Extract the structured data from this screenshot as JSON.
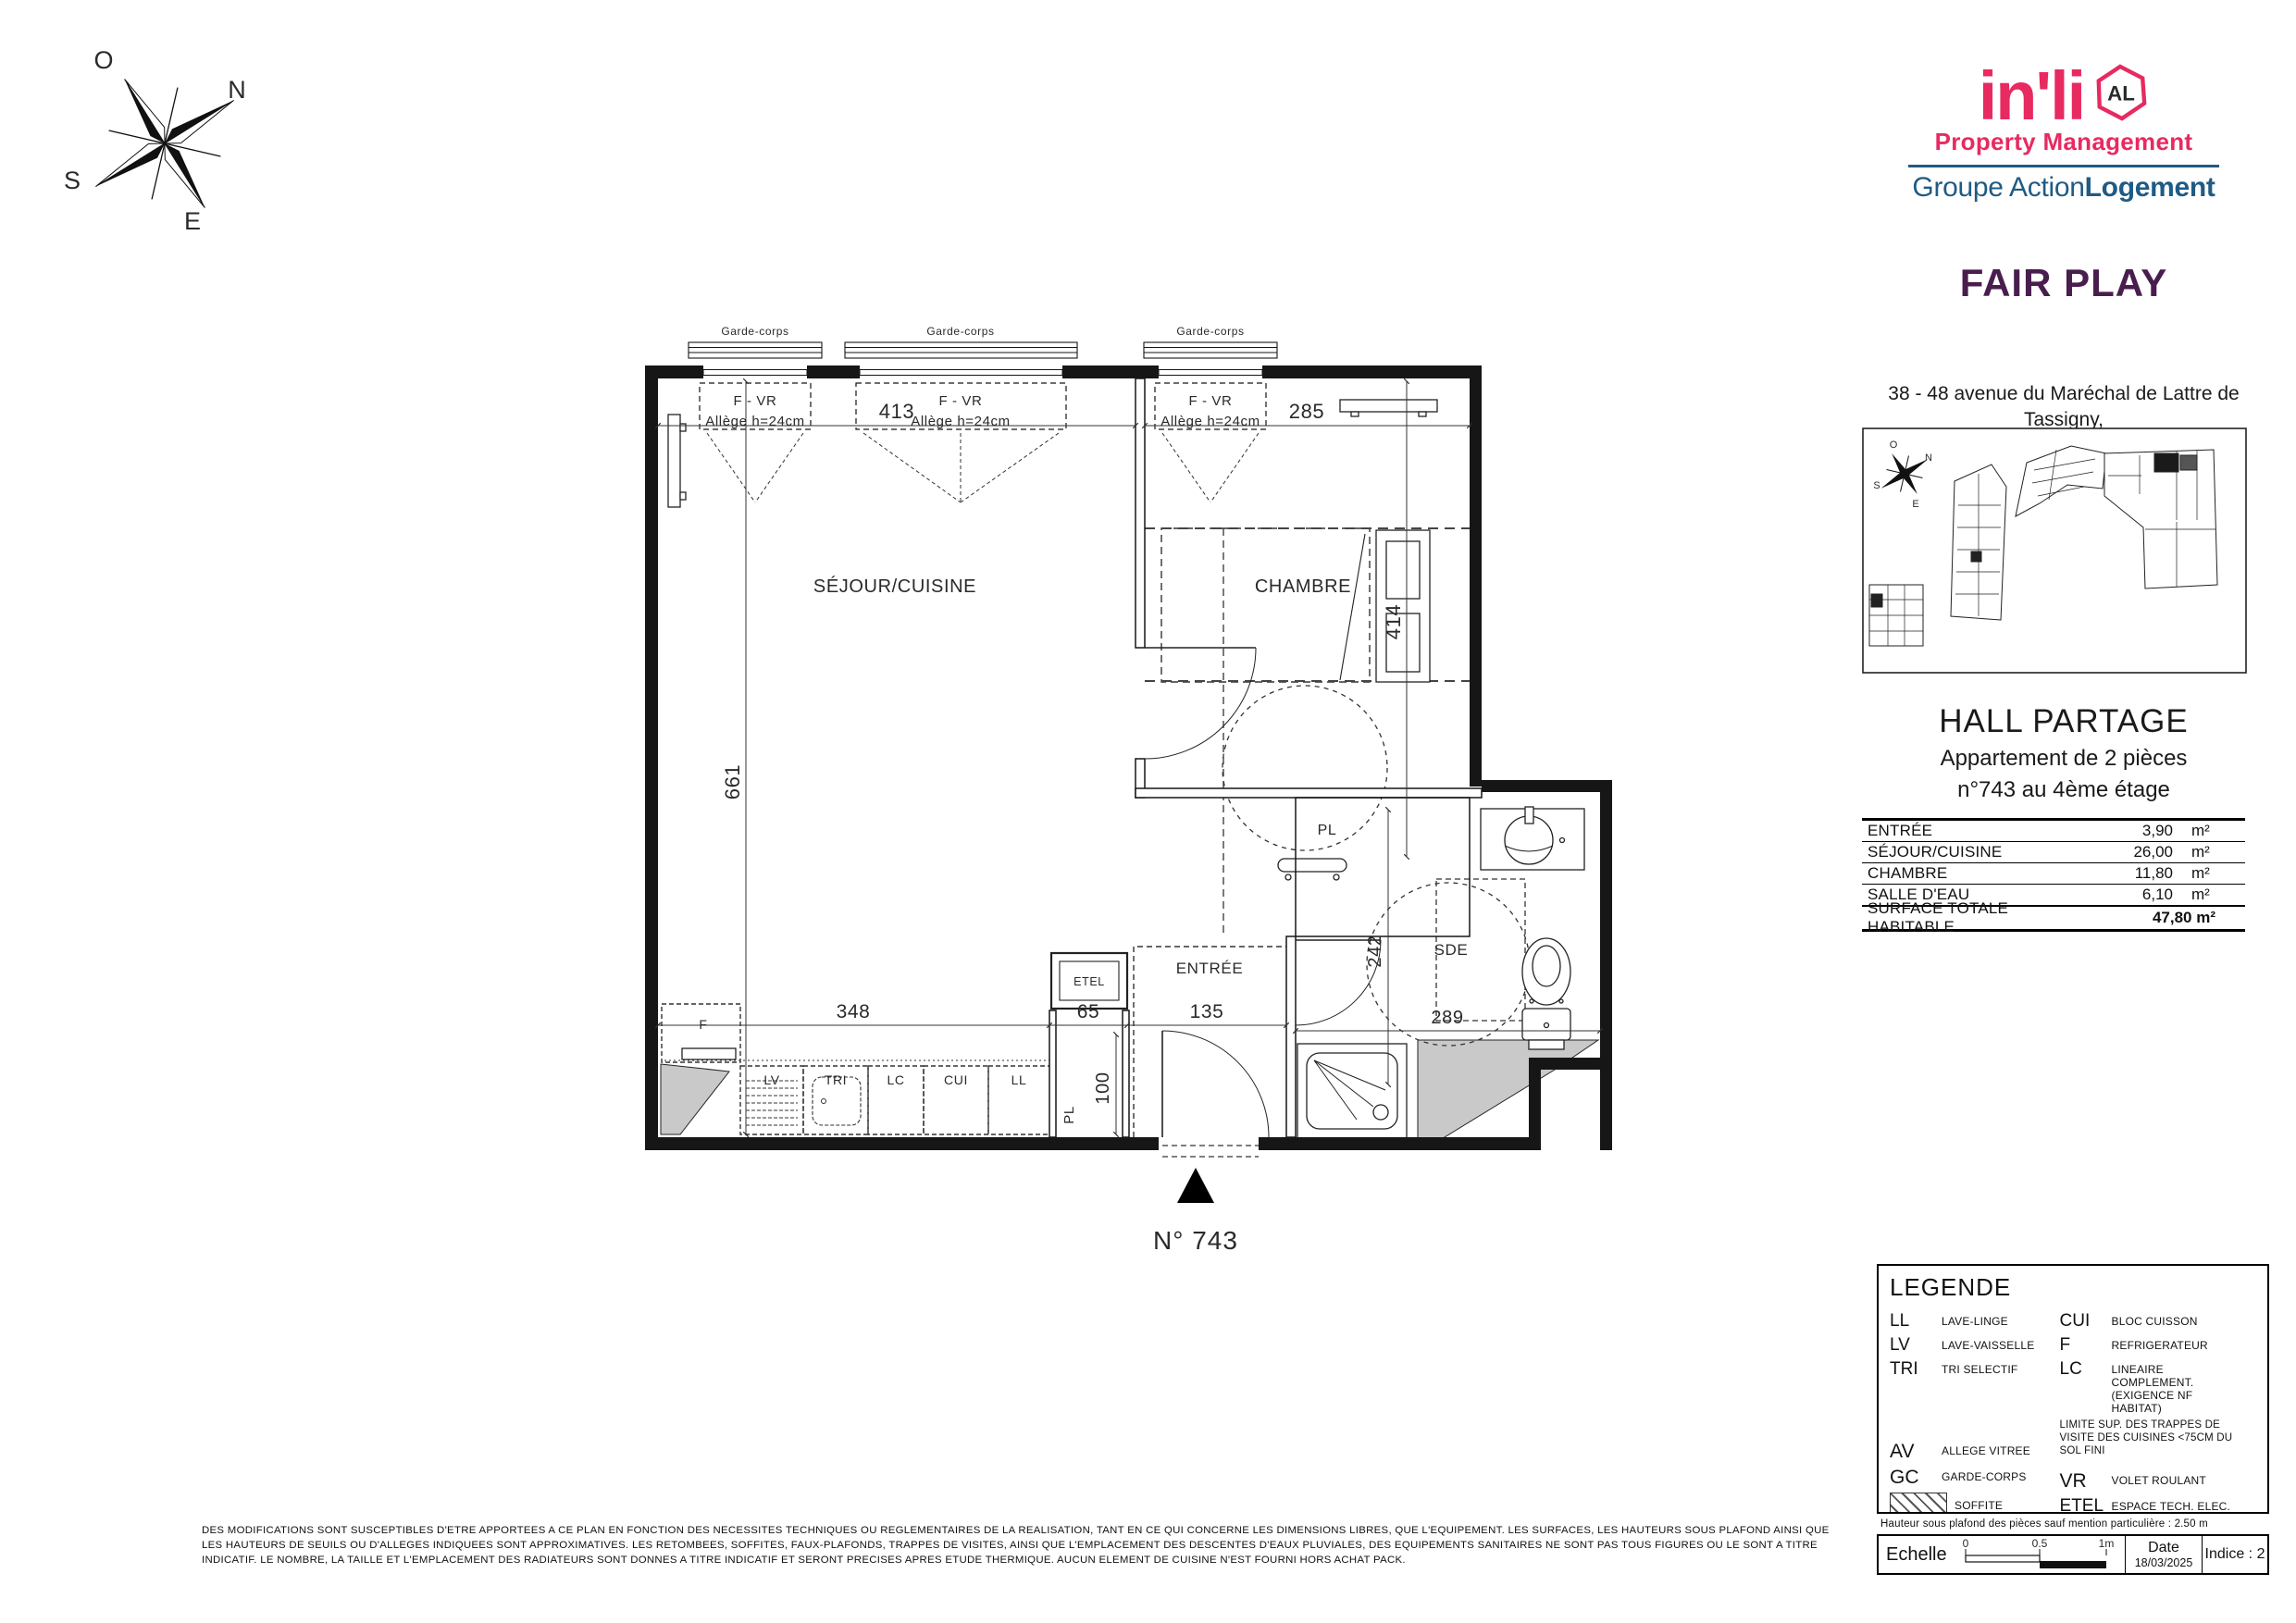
{
  "colors": {
    "pink": "#e72a60",
    "blue": "#1f5b84",
    "purple": "#491d4e"
  },
  "compass": {
    "o": "O",
    "n": "N",
    "s": "S",
    "e": "E"
  },
  "logo": {
    "brand": "in'li",
    "badge": "AL",
    "tagline": "Property Management",
    "group_regular": "Groupe Action",
    "group_bold": "Logement"
  },
  "project": {
    "name": "FAIR PLAY",
    "address_line1": "38 - 48 avenue du Maréchal de Lattre de Tassigny,",
    "address_line2": "93140 BONDY",
    "hall": "HALL PARTAGE",
    "apartment_type": "Appartement de 2 pièces",
    "apartment_floor": "n°743 au 4ème étage",
    "unit_label": "N° 743"
  },
  "surface_table": {
    "rows": [
      {
        "label": "ENTRÉE",
        "value": "3,90",
        "unit": "m²"
      },
      {
        "label": "SÉJOUR/CUISINE",
        "value": "26,00",
        "unit": "m²"
      },
      {
        "label": "CHAMBRE",
        "value": "11,80",
        "unit": "m²"
      },
      {
        "label": "SALLE D'EAU",
        "value": "6,10",
        "unit": "m²"
      }
    ],
    "total": {
      "label": "SURFACE TOTALE HABITABLE",
      "value": "47,80 m²"
    }
  },
  "plan": {
    "rooms": {
      "sejour": "SÉJOUR/CUISINE",
      "chambre": "CHAMBRE",
      "entree": "ENTRÉE",
      "sde": "SDE",
      "pl_upper": "PL",
      "pl_lower": "PL",
      "etel": "ETEL"
    },
    "kitchen": {
      "f": "F",
      "lv": "LV",
      "tri": "TRI",
      "lc": "LC",
      "cui": "CUI",
      "ll": "LL"
    },
    "windows": {
      "garde_corps": "Garde-corps",
      "f_vr": "F - VR",
      "allege": "Allège h=24cm"
    },
    "dims": {
      "d413": "413",
      "d285": "285",
      "d661": "661",
      "d414": "414",
      "d348": "348",
      "d65": "65",
      "d135": "135",
      "d100": "100",
      "d242": "242",
      "d289": "289"
    }
  },
  "legend": {
    "title": "LEGENDE",
    "ll_abbr": "LL",
    "ll": "LAVE-LINGE",
    "lv_abbr": "LV",
    "lv": "LAVE-VAISSELLE",
    "tri_abbr": "TRI",
    "tri": "TRI SELECTIF",
    "av_abbr": "AV",
    "av": "ALLEGE VITREE",
    "gc_abbr": "GC",
    "gc": "GARDE-CORPS",
    "soffite": "SOFFITE",
    "retombee": "RETOMBEE DE POUTRE",
    "cui_abbr": "CUI",
    "cui": "BLOC CUISSON",
    "f_abbr": "F",
    "f": "REFRIGERATEUR",
    "lc_abbr": "LC",
    "lc": "LINEAIRE COMPLEMENT. (EXIGENCE NF HABITAT)",
    "note": "LIMITE SUP. DES TRAPPES DE VISITE DES CUISINES <75CM DU SOL FINI",
    "vr_abbr": "VR",
    "vr": "VOLET ROULANT",
    "etel_abbr": "ETEL",
    "etel": "ESPACE TECH. ELEC. DU LOGEMENT",
    "radiateur": "RADIATEUR",
    "seche": "SECHE-SERV.",
    "ceiling_note": "Hauteur sous plafond des pièces sauf mention particulière : 2.50 m"
  },
  "scale_block": {
    "label": "Echelle",
    "t0": "0",
    "t05": "0.5",
    "t1": "1m",
    "date_label": "Date",
    "date_value": "18/03/2025",
    "indice": "Indice : 2"
  },
  "footer": {
    "line1": "DES MODIFICATIONS SONT SUSCEPTIBLES D'ETRE APPORTEES A CE PLAN EN FONCTION DES NECESSITES TECHNIQUES OU REGLEMENTAIRES DE LA REALISATION, TANT EN CE QUI CONCERNE LES DIMENSIONS LIBRES, QUE L'EQUIPEMENT. LES SURFACES, LES HAUTEURS SOUS PLAFOND AINSI QUE",
    "line2": "LES HAUTEURS DE SEUILS OU D'ALLEGES INDIQUEES SONT APPROXIMATIVES. LES RETOMBEES, SOFFITES, FAUX-PLAFONDS, TRAPPES DE VISITES, AINSI QUE L'EMPLACEMENT DES DESCENTES D'EAUX PLUVIALES, DES EQUIPEMENTS SANITAIRES NE SONT PAS TOUS FIGURES OU LE SONT A TITRE",
    "line3": "INDICATIF. LE NOMBRE, LA TAILLE ET L'EMPLACEMENT DES RADIATEURS SONT DONNES A TITRE INDICATIF ET SERONT PRECISES APRES ETUDE THERMIQUE. AUCUN ELEMENT DE CUISINE N'EST FOURNI HORS ACHAT PACK."
  }
}
